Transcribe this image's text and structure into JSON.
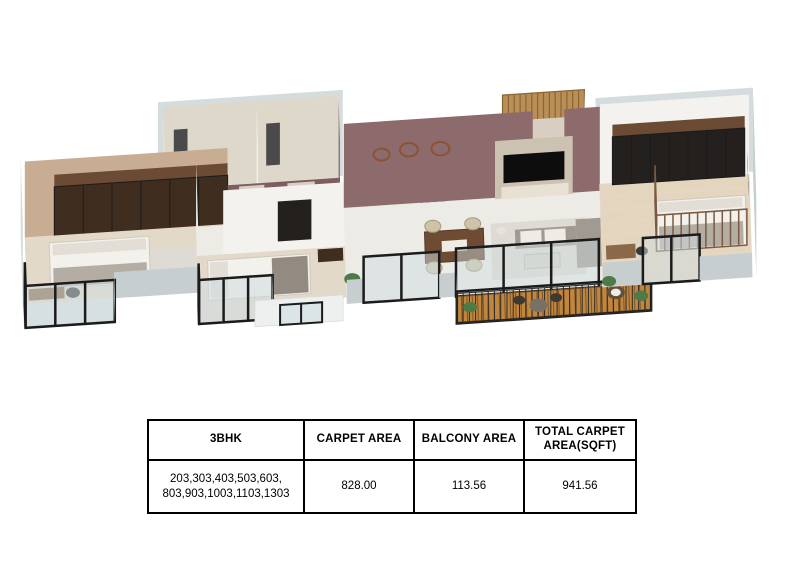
{
  "plan": {
    "type": "3d-isometric-floorplan-render",
    "unit_type": "3BHK",
    "rooms": [
      "master-bedroom",
      "master-balcony",
      "bathroom-1",
      "bathroom-2",
      "corridor",
      "second-bedroom",
      "kitchen",
      "utility-balcony",
      "entrance-foyer",
      "living-room",
      "dining-area",
      "deck-balcony",
      "kids-bedroom"
    ]
  },
  "table": {
    "headers": [
      "3BHK",
      "CARPET AREA",
      "BALCONY AREA",
      "TOTAL CARPET AREA(SQFT)"
    ],
    "row": [
      "203,303,403,503,603, 803,903,1003,1103,1303",
      "828.00",
      "113.56",
      "941.56"
    ]
  },
  "colors": {
    "shellGray": "#d5dcdd",
    "shellGrayDark": "#c6ced0",
    "wallWhite": "#f4f2ee",
    "wallCream": "#ece7de",
    "wallBeige": "#c9ad92",
    "wallTile": "#ddd8ca",
    "tileSide": "#e8e3d6",
    "accentMauve": "#8d6a6c",
    "accentMauveDark": "#7f5c5f",
    "doorCream": "#d8cfc2",
    "floorMarble": "#edebe6",
    "floorBeige": "#e3d9c9",
    "floorTile": "#d8d3c6",
    "floorWood": "#e4d5bf",
    "balconyFloor": "#dde0e1",
    "deckWood": "#c1863e",
    "deckStripe": "#7e5526",
    "woodDark": "#3f2d1f",
    "woodMid": "#6b4b33",
    "slatWood": "#b98e57",
    "slatStripe": "#8a6535",
    "frameBlack": "#1b1b1b",
    "frameGray": "#2a2a2a",
    "glass": "#cfdde1",
    "bedWhite": "#f3f1ec",
    "pillow": "#e2ddd5",
    "blanket": "#b4ada4",
    "blanketDark": "#938a81",
    "sofaGray": "#a09a92",
    "cushionWhite": "#efece6",
    "rug": "#dedbd4",
    "tableWood": "#6e4c34",
    "tableTopGray": "#d9d4cc",
    "chairBeige": "#cdc3a8",
    "counterTop": "#efeee9",
    "counterDark": "#322b27",
    "applianceDark": "#24201e",
    "green": "#4d7a45",
    "deskWood": "#8a6848",
    "chairDark": "#3a3a3a",
    "fixtureDark": "#4a4a4a",
    "utilFloor": "#e9ebeb",
    "utilWall": "#eef0f0",
    "white": "#ffffff",
    "tvPanel": "#ccc2b1",
    "console": "#e8e1d3",
    "tvBlack": "#0d0d0d",
    "plateBrown": "#8a5434",
    "railWood": "#7a5a40",
    "deckTable": "#7a7065",
    "deckChair": "#3f3833",
    "rattan": "#63503c",
    "lamp": "#e7e3da",
    "sinkGray": "#c3c7c5",
    "tableBorder": "#000000"
  }
}
